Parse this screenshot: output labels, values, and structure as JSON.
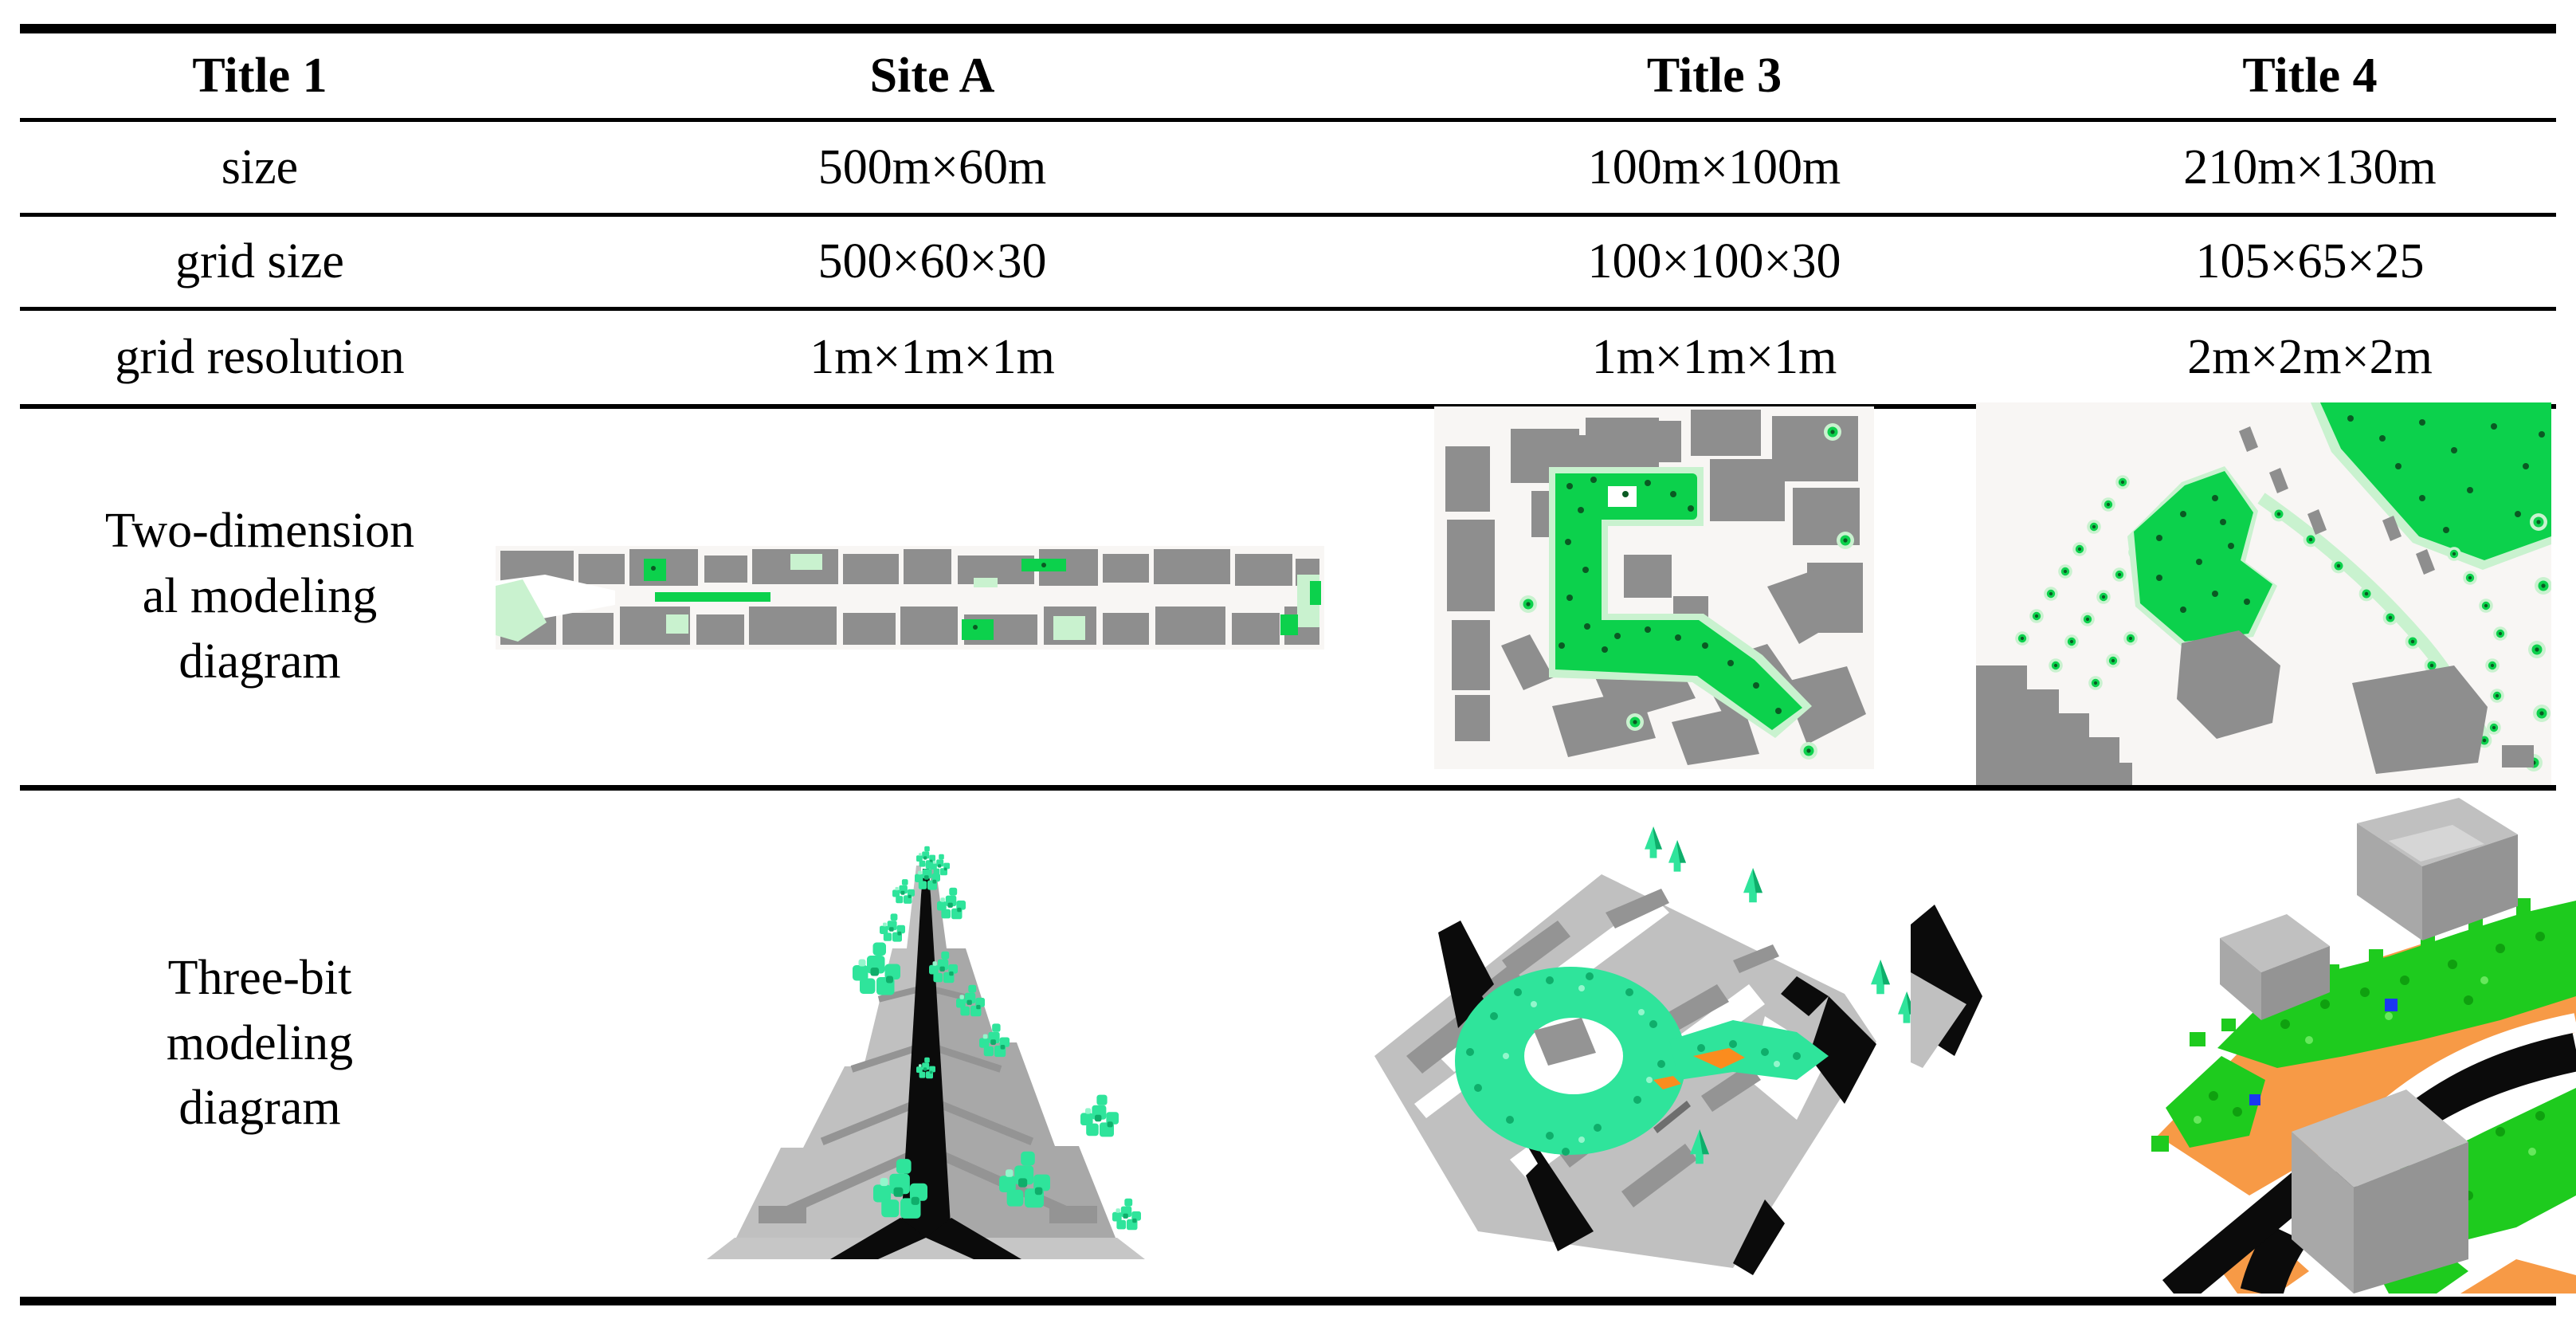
{
  "colors": {
    "rule": "#000000",
    "text": "#000000",
    "map_bg": "#f8f6f4",
    "bldg2d": "#8e8e8e",
    "veg_bright": "#0cd14c",
    "veg_pale": "#c9f2cf",
    "veg_dot": "#0a5a23",
    "mint": "#2fe49b",
    "mint_dark": "#0fae6b",
    "mint_light": "#93f6cc",
    "b3d": "#c0c0c0",
    "b3d_mid": "#a8a8a8",
    "b3d_dark": "#949494",
    "b3d_darker": "#6e6e6e",
    "b3d_light": "#d6d6d6",
    "road": "#0b0b0b",
    "g3": "#1ecb1e",
    "g3_dark": "#0fa00f",
    "g3_light": "#66e85c",
    "orange": "#f79a46",
    "orange_deep": "#fb8c1e",
    "blue": "#1b36f2",
    "ground": "#c6c6c6"
  },
  "table": {
    "header": [
      "Title 1",
      "Site A",
      "Title 3",
      "Title 4"
    ],
    "rows": [
      {
        "label": "size",
        "values": [
          "500m×60m",
          "100m×100m",
          "210m×130m"
        ]
      },
      {
        "label": "grid size",
        "values": [
          "500×60×30",
          "100×100×30",
          "105×65×25"
        ]
      },
      {
        "label": "grid resolution",
        "values": [
          "1m×1m×1m",
          "1m×1m×1m",
          "2m×2m×2m"
        ]
      }
    ],
    "row_2d": {
      "label_lines": [
        "Two-dimension",
        "al modeling",
        "diagram"
      ]
    },
    "row_3d": {
      "label_lines": [
        "Three-bit",
        "modeling",
        "diagram"
      ]
    }
  }
}
